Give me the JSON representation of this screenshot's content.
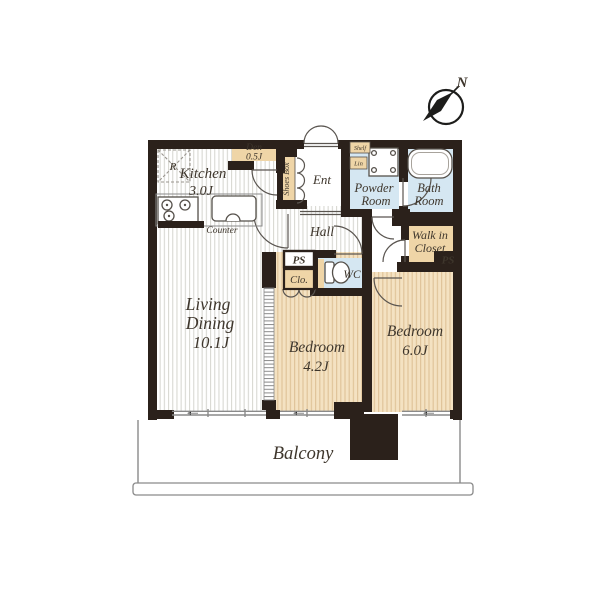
{
  "page": {
    "background": "#ffffff"
  },
  "compass": {
    "north_label": "N"
  },
  "rooms": {
    "kitchen": {
      "name": "Kitchen",
      "size": "3.0J"
    },
    "den": {
      "name": "Den",
      "size": "0.5J"
    },
    "entrance": {
      "name": "Ent"
    },
    "shoes_box": {
      "name": "Shoes Box"
    },
    "powder_room": {
      "name_line1": "Powder",
      "name_line2": "Room"
    },
    "bath_room": {
      "name_line1": "Bath",
      "name_line2": "Room"
    },
    "hall": {
      "name": "Hall"
    },
    "wc": {
      "name": "WC"
    },
    "walk_in_closet": {
      "name_line1": "Walk in",
      "name_line2": "Closet"
    },
    "bedroom_small": {
      "name": "Bedroom",
      "size": "4.2J"
    },
    "bedroom_large": {
      "name": "Bedroom",
      "size": "6.0J"
    },
    "living_dining": {
      "name_line1": "Living",
      "name_line2": "Dining",
      "size": "10.1J"
    },
    "closet": {
      "name": "Clo."
    },
    "balcony": {
      "name": "Balcony"
    }
  },
  "fixtures": {
    "refrigerator": "R",
    "counter": "Counter",
    "shelf": "Shelf",
    "linen": "Lin"
  },
  "utility": {
    "pipe_space": "PS"
  },
  "colors": {
    "wall": "#2b211b",
    "tatami_tan": "#efd5a7",
    "bedroom_floor": "#f4e2c2",
    "bedroom_stripe": "#e0c49a",
    "wet_area_blue": "#d5e7f2",
    "floor_stripe": "#d8d8d3",
    "text": "#3e362c"
  }
}
